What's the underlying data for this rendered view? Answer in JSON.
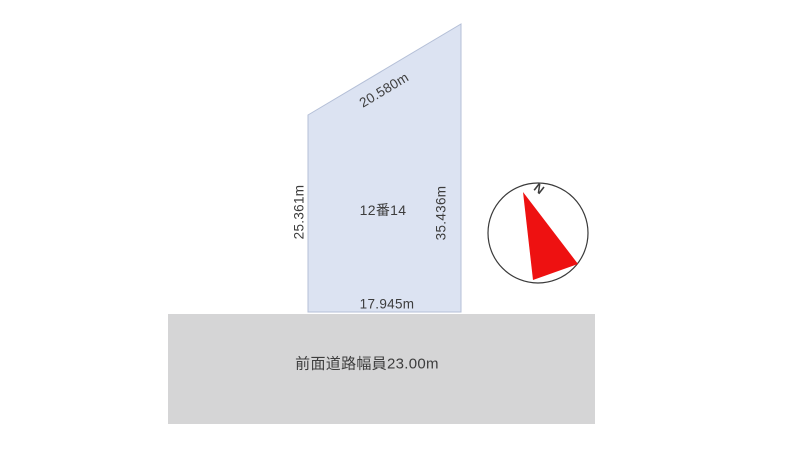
{
  "parcel": {
    "lot_label": "12番14",
    "dim_top": "20.580m",
    "dim_left": "25.361m",
    "dim_right": "35.436m",
    "dim_bottom": "17.945m"
  },
  "road": {
    "label": "前面道路幅員23.00m"
  },
  "compass": {
    "north_label": "N"
  },
  "colors": {
    "parcel_fill": "#dce3f2",
    "parcel_stroke": "#b4bfd7",
    "road_fill": "#d5d5d6",
    "text": "#3d3d3d",
    "north_arrow_red": "#ee1111",
    "compass_outline": "#3a3a3a",
    "compass_fill": "#ffffff"
  }
}
